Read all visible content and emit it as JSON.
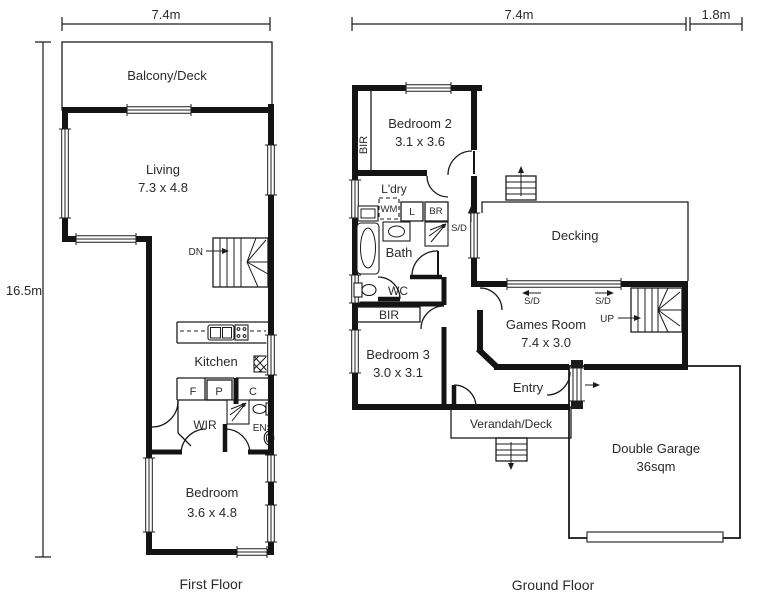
{
  "first_floor": {
    "title": "First Floor",
    "dim_top": "7.4m",
    "dim_left": "16.5m",
    "labels": {
      "balcony": "Balcony/Deck",
      "living": "Living",
      "living_size": "7.3 x 4.8",
      "stairs": "DN",
      "kitchen": "Kitchen",
      "fridge": "F",
      "pantry": "P",
      "cupboard": "C",
      "wir": "WIR",
      "ensuite": "ENS",
      "bedroom": "Bedroom",
      "bedroom_size": "3.6 x 4.8"
    }
  },
  "ground_floor": {
    "title": "Ground Floor",
    "dim_top_main": "7.4m",
    "dim_top_garage": "1.8m",
    "labels": {
      "bir_bed2": "BIR",
      "bedroom2": "Bedroom 2",
      "bedroom2_size": "3.1 x 3.6",
      "laundry": "L'dry",
      "washing_machine": "WM",
      "linen": "L",
      "broom": "BR",
      "bath": "Bath",
      "sd_bath": "S/D",
      "wc": "WC",
      "bir_bed3": "BIR",
      "bedroom3": "Bedroom 3",
      "bedroom3_size": "3.0 x 3.1",
      "decking": "Decking",
      "sd_left": "S/D",
      "sd_right": "S/D",
      "games_room": "Games Room",
      "games_room_size": "7.4 x 3.0",
      "stairs": "UP",
      "entry": "Entry",
      "verandah": "Verandah/Deck",
      "garage": "Double Garage",
      "garage_size": "36sqm"
    }
  }
}
